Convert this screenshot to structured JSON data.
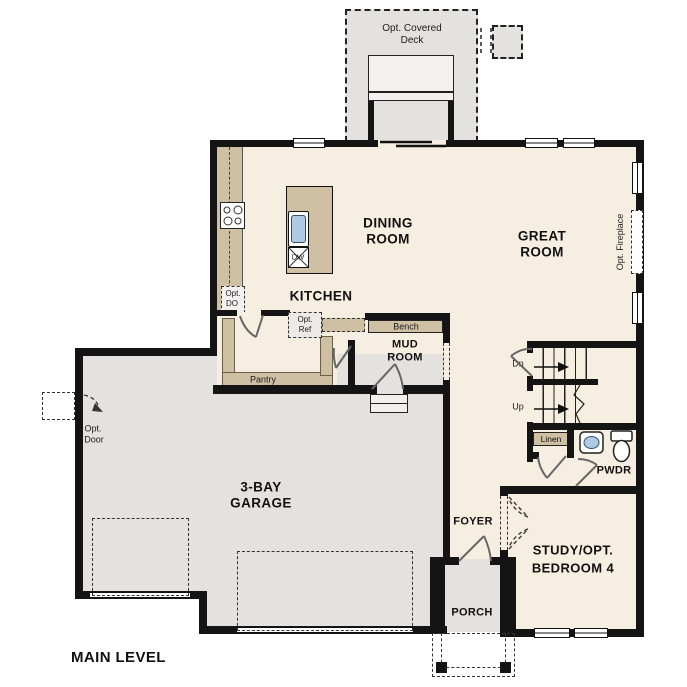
{
  "plan_title": "MAIN LEVEL",
  "colors": {
    "wall": "#141414",
    "floor": "#f6efe1",
    "garage": "#e3e2df",
    "counter": "#cfc0a4",
    "sink": "#aecbe6"
  },
  "rooms": {
    "dining": [
      "DINING",
      "ROOM"
    ],
    "great": [
      "GREAT",
      "ROOM"
    ],
    "kitchen": "KITCHEN",
    "mud": [
      "MUD",
      "ROOM"
    ],
    "garage": [
      "3-BAY",
      "GARAGE"
    ],
    "study": [
      "STUDY/OPT.",
      "BEDROOM 4"
    ],
    "foyer": "FOYER",
    "porch": "PORCH",
    "pwdr": "PWDR"
  },
  "features": {
    "deck": [
      "Opt. Covered",
      "Deck"
    ],
    "bench": "Bench",
    "pantry": "Pantry",
    "linen": "Linen",
    "opt_ref": [
      "Opt.",
      "Ref"
    ],
    "opt_do": [
      "Opt.",
      "DO"
    ],
    "opt_door": [
      "Opt.",
      "Door"
    ],
    "opt_fireplace": "Opt. Fireplace",
    "dw": "DW",
    "stairs_down": "Dn",
    "stairs_up": "Up"
  }
}
